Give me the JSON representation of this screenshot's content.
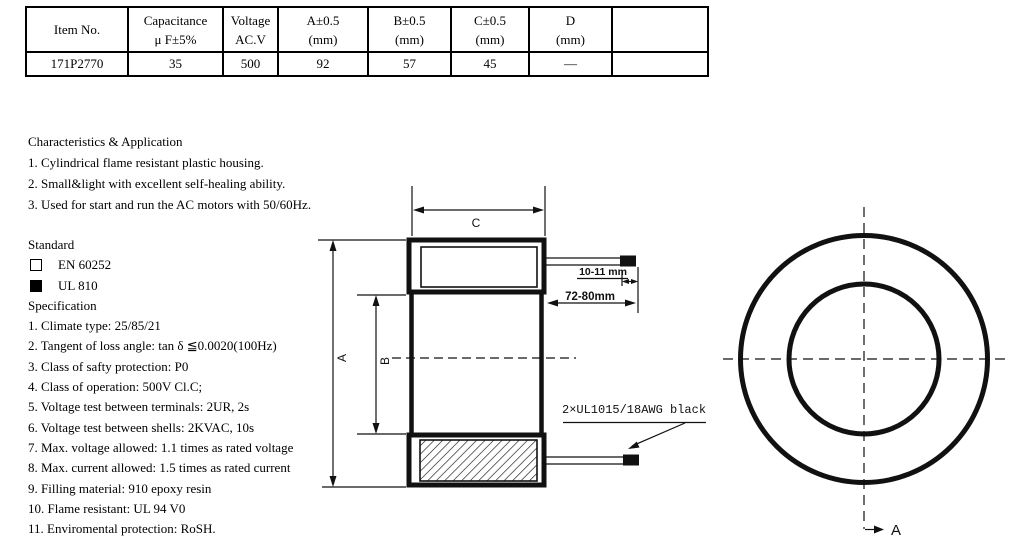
{
  "table": {
    "columns": [
      {
        "line1": "Item No.",
        "line2": ""
      },
      {
        "line1": "Capacitance",
        "line2": "μ F±5%"
      },
      {
        "line1": "Voltage",
        "line2": "AC.V"
      },
      {
        "line1": "A±0.5",
        "line2": "(mm)"
      },
      {
        "line1": "B±0.5",
        "line2": "(mm)"
      },
      {
        "line1": "C±0.5",
        "line2": "(mm)"
      },
      {
        "line1": "D",
        "line2": "(mm)"
      },
      {
        "line1": "",
        "line2": ""
      }
    ],
    "row": {
      "item_no": "171P2770",
      "capacitance": "35",
      "voltage": "500",
      "a": "92",
      "b": "57",
      "c": "45",
      "d": "—",
      "extra": ""
    }
  },
  "characteristics": {
    "title": "Characteristics & Application",
    "items": [
      "1. Cylindrical flame resistant plastic housing.",
      "2. Small&light with excellent self-healing ability.",
      "3. Used for start and run the AC motors with 50/60Hz."
    ]
  },
  "standard": {
    "title": "Standard",
    "options": [
      {
        "label": "EN 60252",
        "checked": false
      },
      {
        "label": "UL 810",
        "checked": true
      }
    ]
  },
  "specification": {
    "title": "Specification",
    "items": [
      "1. Climate type: 25/85/21",
      "2. Tangent of loss angle: tan δ ≦0.0020(100Hz)",
      "3. Class of safty protection: P0",
      "4. Class of operation: 500V Cl.C;",
      "5. Voltage test between terminals: 2UR, 2s",
      "6. Voltage test between shells: 2KVAC, 10s",
      "7. Max. voltage allowed: 1.1 times as rated voltage",
      "8. Max. current allowed: 1.5 times as rated current",
      "9. Filling material: 910 epoxy resin",
      "10. Flame resistant: UL 94 V0",
      "11. Enviromental protection: RoSH."
    ]
  },
  "drawing": {
    "dim_a_label": "A",
    "dim_b_label": "B",
    "dim_c_label": "C",
    "tip_length_dim": "10-11 mm",
    "lead_length_dim": "72-80mm",
    "wire_spec_label": "2×UL1015/18AWG black",
    "section_view_label": "A"
  }
}
